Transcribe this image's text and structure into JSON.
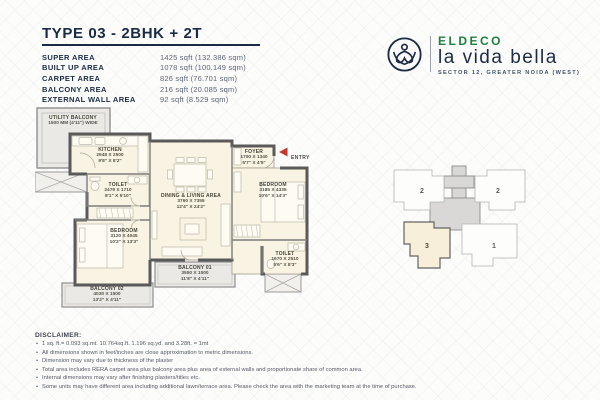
{
  "header": {
    "title": "TYPE 03 - 2BHK + 2T",
    "areas": [
      {
        "label": "SUPER AREA",
        "value": "1425 sqft (132.386 sqm)"
      },
      {
        "label": "BUILT UP AREA",
        "value": "1078 sqft (100.149 sqm)"
      },
      {
        "label": "CARPET AREA",
        "value": "826 sqft (76.701 sqm)"
      },
      {
        "label": "BALCONY AREA",
        "value": "216 sqft (20.085 sqm)"
      },
      {
        "label": "EXTERNAL WALL AREA",
        "value": "92 sqft (8.529 sqm)"
      }
    ]
  },
  "brand": {
    "name": "ELDECO",
    "project": "la vida bella",
    "location": "SECTOR 12, GREATER NOIDA (WEST)",
    "accent_green": "#1e7f3f",
    "accent_navy": "#1c2b45"
  },
  "floorplan": {
    "entry_label": "ENTRY",
    "entry_color": "#c0392b",
    "wall_color": "#5a5a5a",
    "room_fill": "#f8f3e2",
    "balcony_fill": "#ebe9e5",
    "rooms": {
      "utility_balcony": {
        "name": "UTILITY BALCONY",
        "dim": "1500 MM (4'11\") WIDE"
      },
      "kitchen": {
        "name": "KITCHEN",
        "mm": "2948 X 2500",
        "ft": "9'8\" X 8'2\""
      },
      "toilet_1": {
        "name": "TOILET",
        "mm": "2479 X 1710",
        "ft": "8'1\" X 5'10\""
      },
      "dining_living": {
        "name": "DINING & LIVING AREA",
        "mm": "3760 X 7355",
        "ft": "12'4\" X 24'2\""
      },
      "foyer": {
        "name": "FOYER",
        "mm": "1700 X 1340",
        "ft": "5'7\" X 4'5\""
      },
      "bedroom_1": {
        "name": "BEDROOM",
        "mm": "3185 X 4335",
        "ft": "10'6\" X 14'3\""
      },
      "toilet_2": {
        "name": "TOILET",
        "mm": "1670 X 2510",
        "ft": "5'6\" X 8'3\""
      },
      "bedroom_2": {
        "name": "BEDROOM",
        "mm": "3120 X 4045",
        "ft": "10'2\" X 13'3\""
      },
      "balcony_1": {
        "name": "BALCONY 01",
        "mm": "3550 X 1500",
        "ft": "11'8\" X 4'11\""
      },
      "balcony_2": {
        "name": "BALCONY 02",
        "mm": "4030 X 1500",
        "ft": "13'2\" X 4'11\""
      }
    }
  },
  "keyplan": {
    "units": [
      {
        "label": "2"
      },
      {
        "label": "2"
      },
      {
        "label": "3",
        "highlighted": "true"
      },
      {
        "label": "1"
      }
    ]
  },
  "disclaimer": {
    "title": "DISCLAIMER:",
    "lines": [
      "1 sq. ft.= 0.093 sq.mt. 10.764sq.ft. 1.196 sq.yd. and 3.28ft. = 1mt",
      "All dimensions shown in feet/inches are close approximation to metric dimensions.",
      "Dimension may vary due to thickness of the plaster",
      "Total area includes RERA carpet area plus balcony area plus area of external walls and proportionate share of common area.",
      "Internal dimensions may vary after finishing plasters/titles etc.",
      "Some units may have different area including additional lawn/terrace area. Please check the area with the marketing team at the time of purchase."
    ]
  }
}
